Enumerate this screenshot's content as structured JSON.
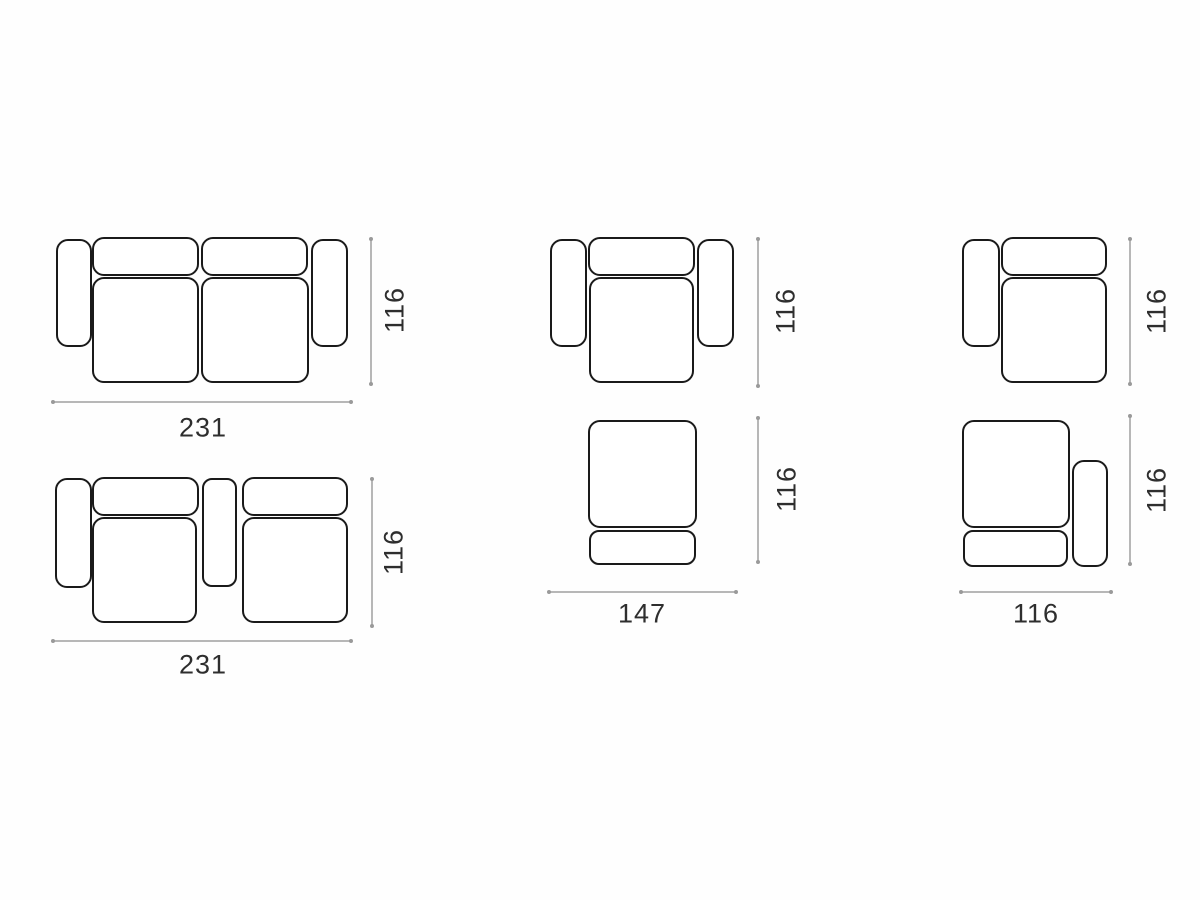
{
  "diagram": {
    "title": "sofa-module-dimension-diagram",
    "colors": {
      "outline": "#1a1a1a",
      "dimension_line": "#b7b7b7",
      "label": "#2e2e2e",
      "background": "#fefefe"
    },
    "figures": [
      {
        "name": "two-seat-sofa-both-arms",
        "width": "231",
        "height": "116"
      },
      {
        "name": "armchair-both-arms",
        "height": "116"
      },
      {
        "name": "one-arm-module-left-arm",
        "height": "116"
      },
      {
        "name": "two-seat-sofa-console-left-arm",
        "width": "231",
        "height": "116"
      },
      {
        "name": "backless-module",
        "width": "147",
        "height": "116"
      },
      {
        "name": "one-arm-module-right-arm",
        "width": "116",
        "height": "116"
      }
    ]
  }
}
